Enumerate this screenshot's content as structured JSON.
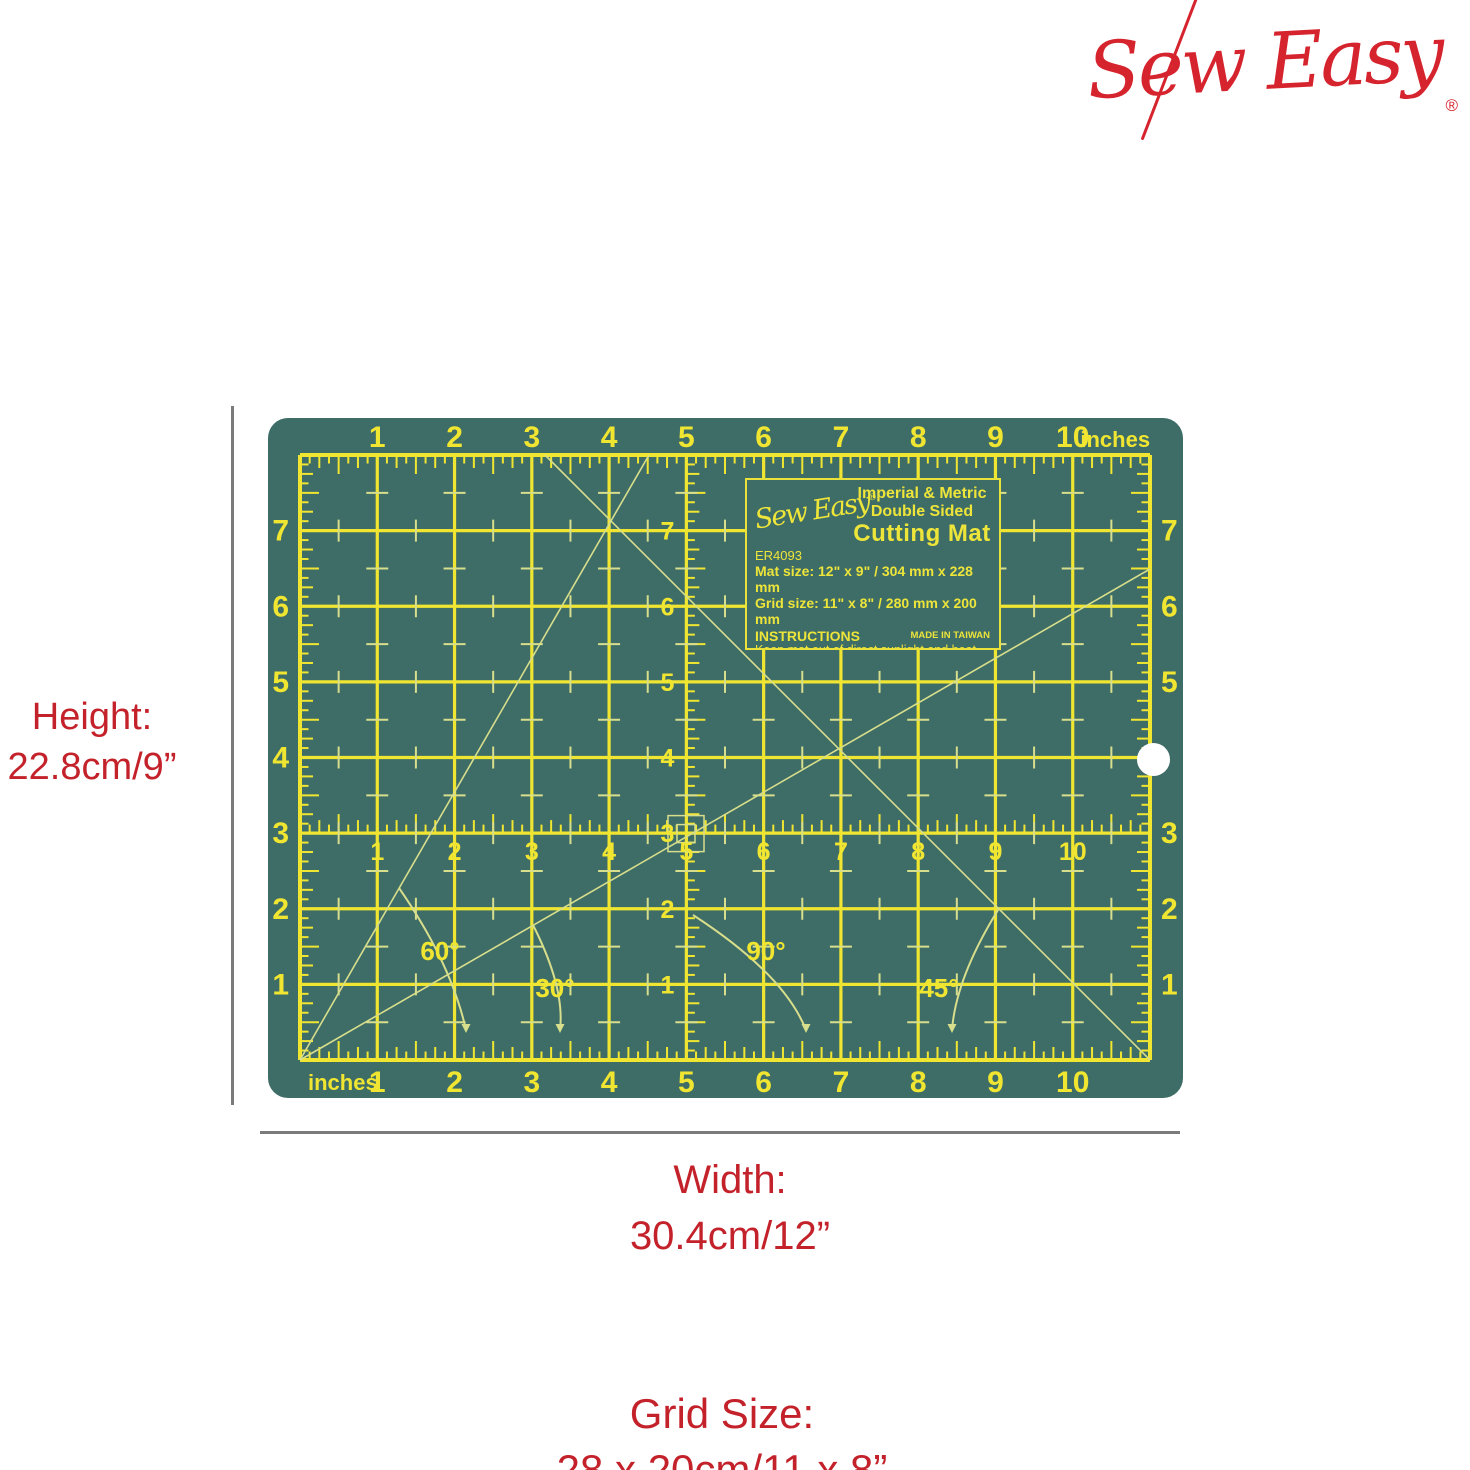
{
  "logo": {
    "text": "Sew Easy",
    "registered": "®",
    "color": "#D6242E"
  },
  "annotations": {
    "height": {
      "label": "Height:",
      "value": "22.8cm/9”"
    },
    "width": {
      "label": "Width:",
      "value": "30.4cm/12”"
    },
    "grid_size": {
      "label": "Grid Size:",
      "value": "28 x 20cm/11 x 8”"
    }
  },
  "mat": {
    "colors": {
      "mat": "#3E6C66",
      "grid": "#F0E632",
      "pale": "#D7DE8C",
      "hole": "#FFFFFF"
    },
    "rulers": {
      "top": {
        "numbers": [
          "1",
          "2",
          "3",
          "4",
          "5",
          "6",
          "7",
          "8",
          "9",
          "10"
        ],
        "unit": "inches"
      },
      "bottom": {
        "numbers": [
          "1",
          "2",
          "3",
          "4",
          "5",
          "6",
          "7",
          "8",
          "9",
          "10"
        ],
        "unit": "inches"
      },
      "left": {
        "numbers": [
          "1",
          "2",
          "3",
          "4",
          "5",
          "6",
          "7"
        ]
      },
      "right": {
        "numbers": [
          "1",
          "2",
          "3",
          "4",
          "5",
          "6",
          "7"
        ],
        "hidden_by_hole": "4"
      },
      "middle": {
        "numbers": [
          "1",
          "2",
          "3",
          "4",
          "5",
          "6",
          "7",
          "8",
          "9",
          "10"
        ]
      },
      "center": {
        "numbers": [
          "1",
          "2",
          "3",
          "4",
          "5",
          "6",
          "7"
        ]
      }
    },
    "angles": [
      "60°",
      "30°",
      "90°",
      "45°"
    ],
    "label": {
      "brand": "Sew Easy",
      "registered": "®",
      "heading_line1": "Imperial & Metric",
      "heading_line2": "Double Sided",
      "title": "Cutting Mat",
      "model": "ER4093",
      "mat_size": "Mat size: 12\" x 9\" / 304 mm x 228 mm",
      "grid_size": "Grid size: 11\" x 8\" / 280 mm x 200 mm",
      "instructions_heading": "INSTRUCTIONS",
      "instructions": [
        "Keep mat out of direct sunlight and heat.",
        "Store mat flat - Do not roll.",
        "Cut in different positions to",
        "extend the life of the mat."
      ],
      "made_in": "MADE IN TAIWAN"
    }
  }
}
